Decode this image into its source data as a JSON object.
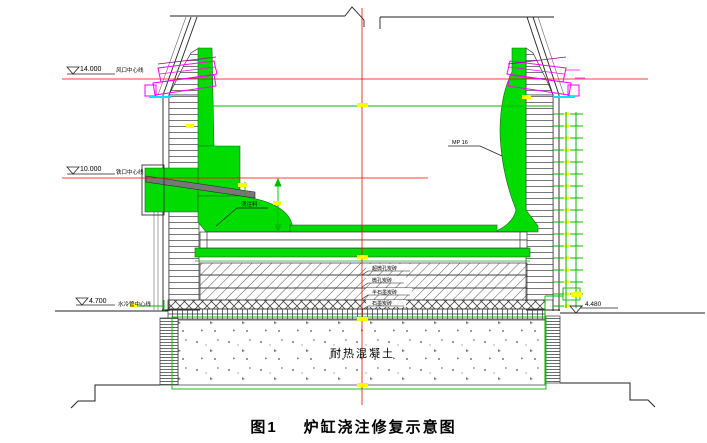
{
  "drawing": {
    "caption": {
      "prefix": "图1",
      "title": "炉缸浇注修复示意图"
    },
    "levels": {
      "tuyere": {
        "elevation": "14.000",
        "label": "风口中心线"
      },
      "taphole": {
        "elevation": "10.000",
        "label": "铁口中心线"
      },
      "cooling": {
        "elevation": "4.700",
        "label": "水冷管中心线"
      },
      "foundation_top": {
        "elevation": "4.480"
      }
    },
    "annotations": {
      "castable": "浇注料",
      "stave_grade": "MP 16",
      "concrete": "耐热混凝土"
    },
    "bottom_layers": [
      "超微孔炭砖",
      "微孔炭砖",
      "半石墨炭砖",
      "石墨炭砖"
    ],
    "colors": {
      "lining_green": "#00dc00",
      "tuyere_magenta": "#ff00ff",
      "centerline_red": "#ff0000",
      "highlight_yellow": "#ffff00",
      "cooling_cyan": "#00e5ff"
    }
  }
}
